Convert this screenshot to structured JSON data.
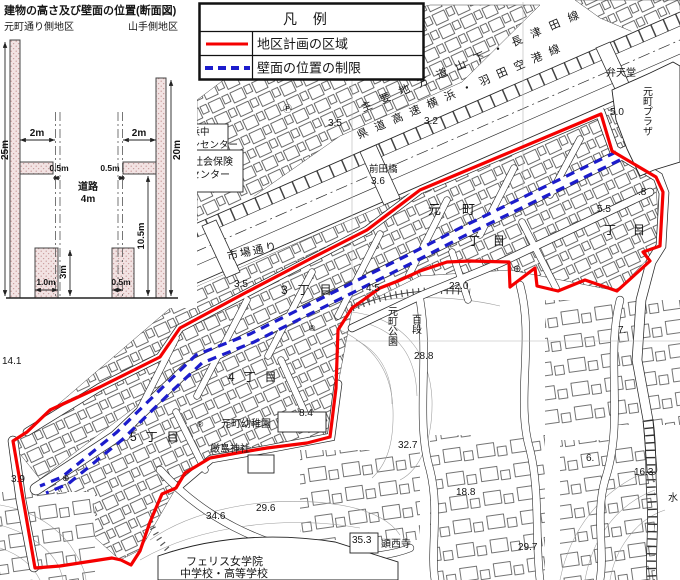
{
  "cross_section": {
    "title": "建物の高さ及び壁面の位置(断面図)",
    "left_area_label": "元町通り側地区",
    "right_area_label": "山手側地区",
    "dims": {
      "left_height": "25m",
      "right_height": "20m",
      "top_setback_left": "2m",
      "top_setback_right": "2m",
      "road_setback_left": "0.5m",
      "road_setback_right": "0.5m",
      "road_name": "道路",
      "road_width": "4m",
      "mid_height": "10.5m",
      "low_height": "3m",
      "bottom_setback_left": "1.0m",
      "bottom_setback_right": "0.5m"
    }
  },
  "legend": {
    "title": "凡  例",
    "items": [
      {
        "label": "地区計画の区域",
        "symbol": "red-solid-line",
        "color": "#f50000"
      },
      {
        "label": "壁面の位置の制限",
        "symbol": "blue-dashed-line",
        "color": "#1c1ccc"
      }
    ]
  },
  "map": {
    "roads": {
      "r1": "主要地方道山下・長津田線",
      "r2": "県道高速横浜・羽田空港線",
      "ichiba": "市場通り"
    },
    "districts": {
      "motomachi": "元町",
      "chome1": "丁目",
      "chome2": "丁目",
      "chome3": "3丁目",
      "chome4": "4丁目",
      "chome5": "5丁目"
    },
    "places": {
      "benten": "弁天堂",
      "plaza": "元町プラザ",
      "park_a": "元町公園",
      "park_b": "百段",
      "kindergarten": "元町幼稚園",
      "shrine": "厳島神社",
      "ferris_1": "フェリス女学院",
      "ferris_2": "中学校・高等学校",
      "kensaiji": "顕西寺",
      "yokohama_1": "横浜中",
      "yokohama_2": "マンセンター",
      "shakai_1": "社会保険",
      "shakai_2": "センター",
      "maedabashi": "前田橋",
      "mizu": "水"
    },
    "elevations": {
      "e20": "2.0",
      "e35a": "3.5",
      "e32": "3.2",
      "e36": "3.6",
      "e35b": "3.5",
      "e45": "4.5",
      "e50": "5.0",
      "e55": "5.5",
      "e8": ".8",
      "e7": "7.",
      "e66": "6.",
      "e220": "22.0",
      "e288": "28.8",
      "e84": "8.4",
      "e141": "14.1",
      "e39": "3.9",
      "e346": "34.6",
      "e296": "29.6",
      "e327": "32.7",
      "e188": "18.8",
      "e297": "29.7",
      "e163": "16.3",
      "e353": "35.3"
    },
    "symbols": {
      "parking": "Ⓟ",
      "post": "⊕",
      "reg1": "®",
      "reg2": "®",
      "post2": "⊕"
    }
  }
}
